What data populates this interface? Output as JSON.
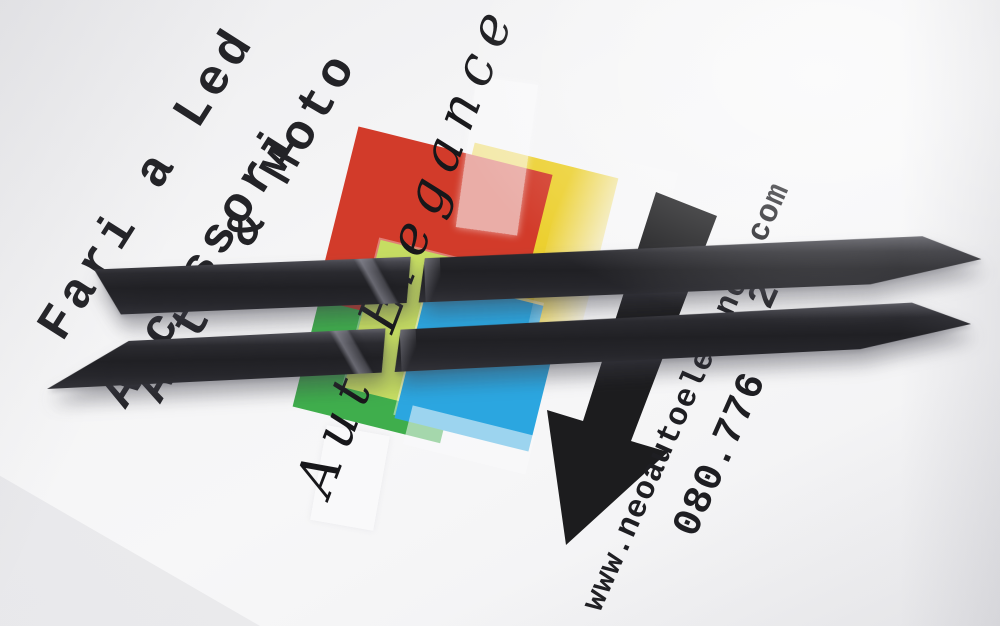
{
  "photo": {
    "print": {
      "type_lines": [
        "Fari a Led",
        "Accessori",
        "Auto & Moto"
      ],
      "brand_script": "AutoElegance",
      "contact": {
        "website": "www.neoautoelegance.com",
        "phone_visible_start": "080.776",
        "phone_visible_end": "29"
      },
      "arrow_icon": "down-left-arrow"
    },
    "product": {
      "items": "two black trim strips",
      "strip_count": 2
    },
    "colors": {
      "paper": "#f5f5f6",
      "ink": "#232327",
      "strip_black": "#232327",
      "logo_red": "#d23b2a",
      "logo_yellow": "#ecd030",
      "logo_green": "#3fae4c",
      "logo_lime": "#c6dd62",
      "logo_blue": "#2ba6e0"
    }
  }
}
